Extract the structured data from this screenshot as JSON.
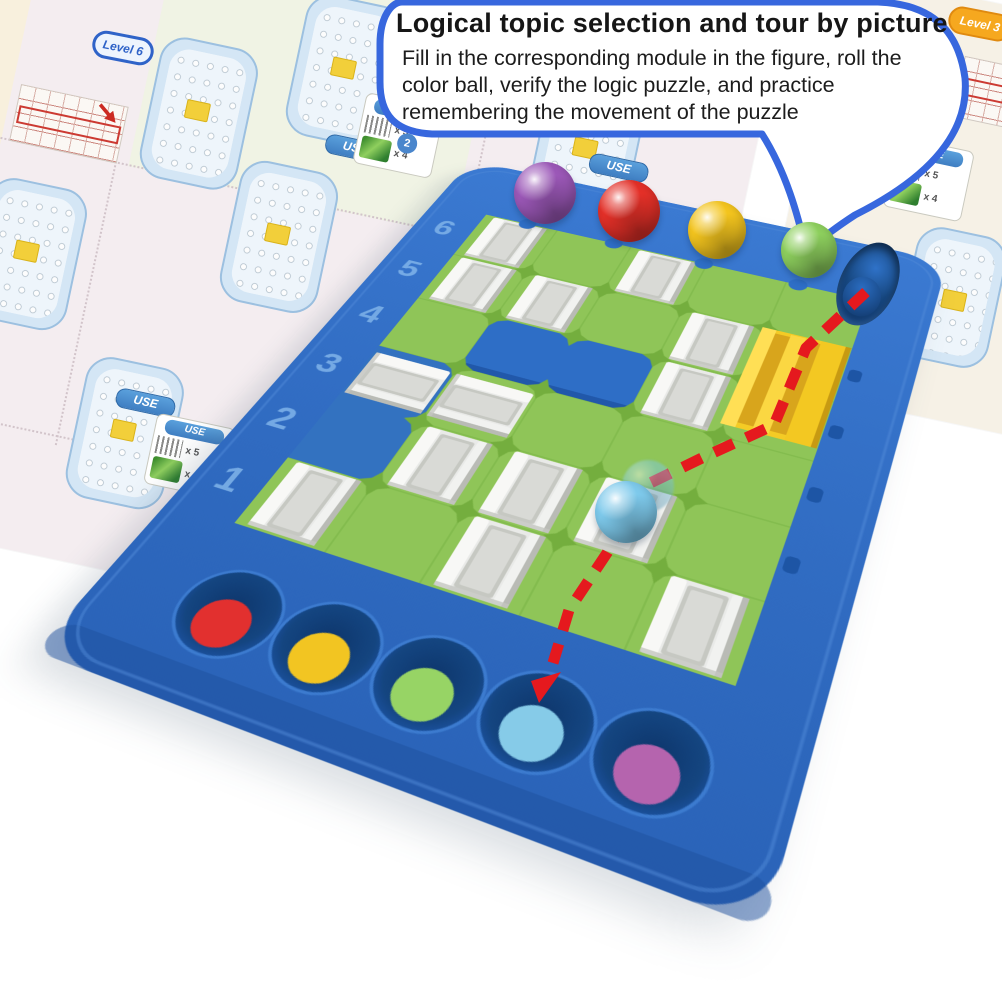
{
  "bubble": {
    "title": "Logical topic selection and tour by picture",
    "body": "Fill in the corresponding module in the figure, roll the color ball, verify the logic puzzle, and practice remembering the movement of the puzzle",
    "border_color": "#3767de"
  },
  "board": {
    "row_labels": [
      "6",
      "5",
      "4",
      "3",
      "2",
      "1"
    ],
    "colors": {
      "base_blue": "#2e6ec6",
      "rim_shadow": "#1d4f9e",
      "field_green": "#8fc558",
      "connector_green": "#74ae3e",
      "wall_white": "#e9eae8",
      "yellow_block": "#f4cb25",
      "well_navy": "#123c78",
      "label_blue": "#7cb0e8"
    },
    "top_balls": [
      {
        "name": "purple",
        "color": "#9c58b8"
      },
      {
        "name": "red",
        "color": "#e43028"
      },
      {
        "name": "yellow",
        "color": "#f4c51e"
      },
      {
        "name": "green",
        "color": "#8ed05e"
      }
    ],
    "start_well_ball": {
      "name": "dark-blue",
      "color": "#2a6cc0"
    },
    "rolling_ball": {
      "name": "light-blue",
      "color": "#7ecaec"
    },
    "bottom_balls": [
      {
        "name": "red",
        "color": "#e2302f"
      },
      {
        "name": "yellow",
        "color": "#f2c522"
      },
      {
        "name": "green",
        "color": "#97d465"
      },
      {
        "name": "light-blue",
        "color": "#86cbe8"
      },
      {
        "name": "purple",
        "color": "#b564ae"
      }
    ],
    "path_color": "#e5191e"
  },
  "background": {
    "badges": [
      {
        "label": "Level 6",
        "color": "#2f63c8"
      },
      {
        "label": "Level 3",
        "color": "#f6a81f"
      }
    ],
    "use_label": "USE",
    "legend_counts": [
      "x 5",
      "x 4"
    ],
    "page_badge": "2"
  }
}
